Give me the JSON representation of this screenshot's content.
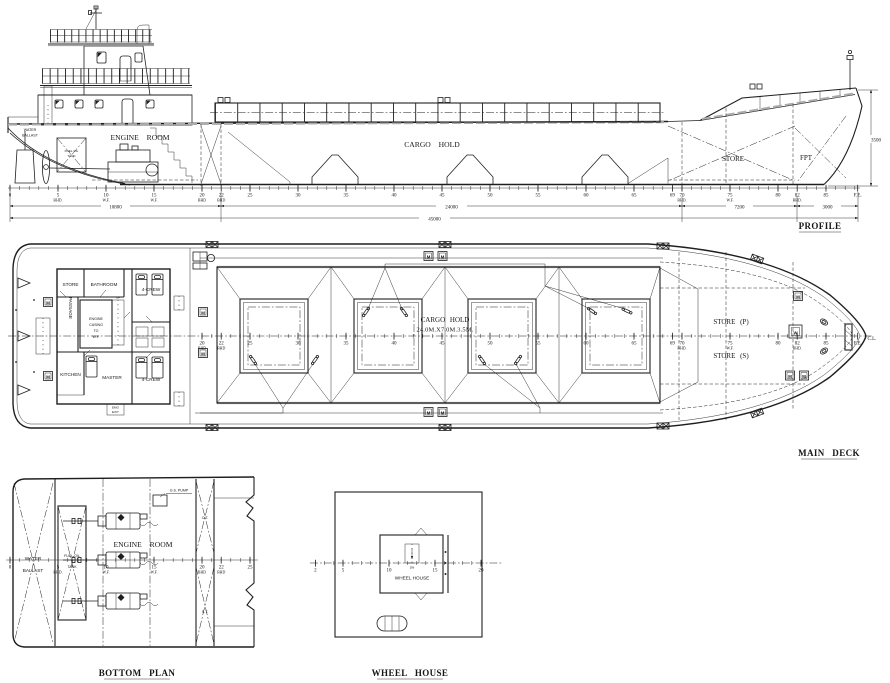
{
  "captions": {
    "profile": "PROFILE",
    "main_deck": "MAIN DECK",
    "bottom_plan": "BOTTOM PLAN",
    "wheel_house": "WHEEL HOUSE"
  },
  "profile": {
    "water_ballast_1": "WATER",
    "water_ballast_2": "BALLAST",
    "fuel_oil_1": "FUEL OIL",
    "fuel_oil_2": "TANK",
    "engine_room": "ENGINE ROOM",
    "cargo_hold": "CARGO HOLD",
    "store": "STORE",
    "fpt": "FPT",
    "dims": {
      "depth": "3500",
      "aft": "10800",
      "hold": "24000",
      "store": "7200",
      "bow": "3000",
      "loa": "45000"
    }
  },
  "main_deck": {
    "rooms": {
      "store": "STORE",
      "bathroom": "BATHROOM",
      "crew_top": "4-CREW",
      "crew_bottom": "4-CREW",
      "passage": "PASSAGE",
      "casing_1": "ENGINE",
      "casing_2": "CASING",
      "casing_3": "TO",
      "casing_4": "W.F.",
      "kitchen": "KITCHEN",
      "master": "MASTER",
      "up": "UP",
      "emg_1": "EMG",
      "emg_2": "EXIT"
    },
    "cargo_hold_1": "CARGO HOLD",
    "cargo_hold_2": "24.0M.X7.0M.3.5M.",
    "store_p": "STORE (P)",
    "store_s": "STORE (S)",
    "cl": "C.L."
  },
  "bottom_plan": {
    "water_ballast_1": "WATER",
    "water_ballast_2": "BALLAST",
    "fuel_oil_1": "FUEL OIL",
    "fuel_oil_2": "TANK",
    "engine_room": "ENGINE ROOM",
    "gs_pump": "G.S. PUMP",
    "ot": "O.T.",
    "st": "S.T."
  },
  "wheel_house": {
    "label": "WHEEL HOUSE",
    "dn": "DN"
  },
  "symbols": {
    "mooring": "M",
    "windlass": "W"
  },
  "scales": {
    "profile": {
      "x0": 10,
      "dx": 9.6,
      "y": 188,
      "min": 0,
      "max": 88,
      "labels": [
        {
          "f": 0,
          "n": "0"
        },
        {
          "f": 5,
          "n": "5",
          "s": "BHD."
        },
        {
          "f": 10,
          "n": "10",
          "s": "W.F."
        },
        {
          "f": 15,
          "n": "15",
          "s": "W.F."
        },
        {
          "f": 20,
          "n": "20",
          "s": "BHD"
        },
        {
          "f": 22,
          "n": "22",
          "s": "BHD"
        },
        {
          "f": 25,
          "n": "25"
        },
        {
          "f": 30,
          "n": "30"
        },
        {
          "f": 35,
          "n": "35"
        },
        {
          "f": 40,
          "n": "40"
        },
        {
          "f": 45,
          "n": "45"
        },
        {
          "f": 50,
          "n": "50"
        },
        {
          "f": 55,
          "n": "55"
        },
        {
          "f": 60,
          "n": "60"
        },
        {
          "f": 65,
          "n": "65"
        },
        {
          "f": 69,
          "n": "69"
        },
        {
          "f": 70,
          "n": "70",
          "s": "BHD."
        },
        {
          "f": 75,
          "n": "75",
          "s": "W.F."
        },
        {
          "f": 80,
          "n": "80"
        },
        {
          "f": 82,
          "n": "82",
          "s": "BHD."
        },
        {
          "f": 85,
          "n": "85"
        },
        {
          "f": 88.3,
          "n": "F.E."
        }
      ]
    },
    "main_deck": {
      "x0": 10,
      "dx": 9.6,
      "y": 336,
      "min": 20,
      "max": 88,
      "labels": [
        {
          "f": 20,
          "n": "20",
          "s": "BHD"
        },
        {
          "f": 22,
          "n": "22",
          "s": "BHD"
        },
        {
          "f": 25,
          "n": "25"
        },
        {
          "f": 30,
          "n": "30"
        },
        {
          "f": 35,
          "n": "35"
        },
        {
          "f": 40,
          "n": "40"
        },
        {
          "f": 45,
          "n": "45"
        },
        {
          "f": 50,
          "n": "50"
        },
        {
          "f": 55,
          "n": "55"
        },
        {
          "f": 60,
          "n": "60"
        },
        {
          "f": 65,
          "n": "65"
        },
        {
          "f": 69,
          "n": "69"
        },
        {
          "f": 70,
          "n": "70",
          "s": "BHD."
        },
        {
          "f": 75,
          "n": "75",
          "s": "W.F."
        },
        {
          "f": 80,
          "n": "80"
        },
        {
          "f": 82,
          "n": "82",
          "s": "BHD."
        },
        {
          "f": 85,
          "n": "85"
        },
        {
          "f": 88.3,
          "n": "F.E."
        }
      ]
    },
    "bottom_plan": {
      "x0": 10,
      "dx": 9.6,
      "y": 560,
      "min": 0,
      "max": 25,
      "labels": [
        {
          "f": 0,
          "n": "0"
        },
        {
          "f": 5,
          "n": "5",
          "s": "BHD."
        },
        {
          "f": 10,
          "n": "10",
          "s": "W.F."
        },
        {
          "f": 15,
          "n": "15",
          "s": "W.F."
        },
        {
          "f": 20,
          "n": "20",
          "s": "BHD"
        },
        {
          "f": 22,
          "n": "22",
          "s": "BHD"
        },
        {
          "f": 25,
          "n": "25"
        }
      ]
    },
    "wheel_house": {
      "x0": 297,
      "dx": 9.2,
      "y": 563,
      "min": 2,
      "max": 20,
      "labels": [
        {
          "f": 2,
          "n": "2"
        },
        {
          "f": 5,
          "n": "5"
        },
        {
          "f": 10,
          "n": "10"
        },
        {
          "f": 15,
          "n": "15"
        },
        {
          "f": 20,
          "n": "20"
        }
      ]
    }
  }
}
